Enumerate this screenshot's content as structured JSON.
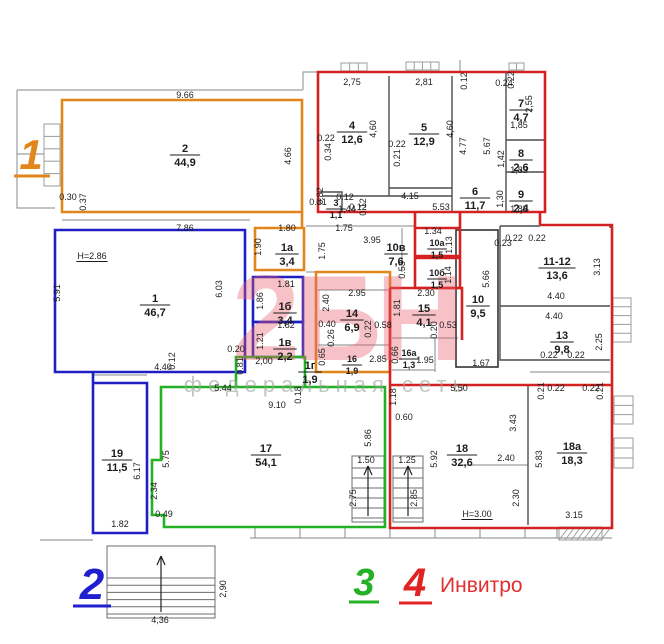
{
  "plan": {
    "wall_color": "#9a9d9f",
    "dark_wall_color": "#4a4d50",
    "dim_color": "#1c1c1c",
    "units": [
      {
        "id": "1",
        "label": "1",
        "color": "#e0861a"
      },
      {
        "id": "2",
        "label": "2",
        "color": "#1f1fc4"
      },
      {
        "id": "3",
        "label": "3",
        "color": "#25b125"
      },
      {
        "id": "4",
        "label": "4",
        "color": "#d42222",
        "name": "Инвитро"
      }
    ],
    "rooms": [
      {
        "n": "2",
        "a": "44,9",
        "x": 185,
        "y": 155
      },
      {
        "n": "1",
        "a": "46,7",
        "x": 155,
        "y": 305
      },
      {
        "n": "19",
        "a": "11,5",
        "x": 117,
        "y": 460
      },
      {
        "n": "17",
        "a": "54,1",
        "x": 266,
        "y": 455
      },
      {
        "n": "18",
        "a": "32,6",
        "x": 462,
        "y": 455
      },
      {
        "n": "18а",
        "a": "18,3",
        "x": 572,
        "y": 453
      },
      {
        "n": "4",
        "a": "12,6",
        "x": 352,
        "y": 132
      },
      {
        "n": "5",
        "a": "12,9",
        "x": 424,
        "y": 134
      },
      {
        "n": "3",
        "a": "1,1",
        "x": 336,
        "y": 209,
        "s": 1
      },
      {
        "n": "6",
        "a": "11,7",
        "x": 475,
        "y": 198
      },
      {
        "n": "7",
        "a": "4,7",
        "x": 521,
        "y": 110
      },
      {
        "n": "8",
        "a": "2,6",
        "x": 521,
        "y": 160
      },
      {
        "n": "9",
        "a": "2,4",
        "x": 521,
        "y": 201
      },
      {
        "n": "1а",
        "a": "3,4",
        "x": 287,
        "y": 254
      },
      {
        "n": "10в",
        "a": "7,6",
        "x": 396,
        "y": 254
      },
      {
        "n": "10а",
        "a": "1,5",
        "x": 437,
        "y": 249,
        "s": 1
      },
      {
        "n": "10б",
        "a": "1,5",
        "x": 437,
        "y": 279,
        "s": 1
      },
      {
        "n": "11-12",
        "a": "13,6",
        "x": 557,
        "y": 268
      },
      {
        "n": "1б",
        "a": "3,4",
        "x": 285,
        "y": 313
      },
      {
        "n": "14",
        "a": "6,9",
        "x": 352,
        "y": 320
      },
      {
        "n": "15",
        "a": "4,1",
        "x": 424,
        "y": 315
      },
      {
        "n": "10",
        "a": "9,5",
        "x": 478,
        "y": 306
      },
      {
        "n": "13",
        "a": "9,8",
        "x": 562,
        "y": 342
      },
      {
        "n": "1в",
        "a": "2,2",
        "x": 285,
        "y": 349
      },
      {
        "n": "16",
        "a": "1,9",
        "x": 352,
        "y": 365,
        "s": 1
      },
      {
        "n": "16а",
        "a": "1,3",
        "x": 409,
        "y": 359,
        "s": 1
      },
      {
        "n": "1г",
        "a": "1,9",
        "x": 310,
        "y": 372
      }
    ],
    "dims": [
      {
        "t": "9.66",
        "x": 185,
        "y": 98
      },
      {
        "t": "0.30",
        "x": 68,
        "y": 200
      },
      {
        "t": "0.37",
        "x": 86,
        "y": 202,
        "v": 1
      },
      {
        "t": "4.66",
        "x": 291,
        "y": 156,
        "v": 1
      },
      {
        "t": "7.86",
        "x": 185,
        "y": 231
      },
      {
        "t": "H=2.86",
        "x": 92,
        "y": 259,
        "u": 1
      },
      {
        "t": "5.91",
        "x": 60,
        "y": 293,
        "v": 1
      },
      {
        "t": "6.03",
        "x": 222,
        "y": 289,
        "v": 1
      },
      {
        "t": "4.40",
        "x": 163,
        "y": 370
      },
      {
        "t": "0.12",
        "x": 175,
        "y": 361,
        "v": 1
      },
      {
        "t": "0.20",
        "x": 236,
        "y": 352
      },
      {
        "t": "0.81",
        "x": 243,
        "y": 366,
        "v": 1
      },
      {
        "t": "1.80",
        "x": 287,
        "y": 231
      },
      {
        "t": "1.90",
        "x": 261,
        "y": 247,
        "v": 1
      },
      {
        "t": "1.75",
        "x": 344,
        "y": 231
      },
      {
        "t": "1.75",
        "x": 325,
        "y": 251,
        "v": 1
      },
      {
        "t": "3.95",
        "x": 372,
        "y": 243
      },
      {
        "t": "0.53",
        "x": 405,
        "y": 270,
        "v": 1
      },
      {
        "t": "1.34",
        "x": 433,
        "y": 234
      },
      {
        "t": "1.13",
        "x": 452,
        "y": 245,
        "v": 1
      },
      {
        "t": "1.14",
        "x": 451,
        "y": 275,
        "v": 1
      },
      {
        "t": "1.81",
        "x": 286,
        "y": 287
      },
      {
        "t": "1.86",
        "x": 263,
        "y": 301,
        "v": 1
      },
      {
        "t": "1.82",
        "x": 286,
        "y": 328
      },
      {
        "t": "1.21",
        "x": 263,
        "y": 341,
        "v": 1
      },
      {
        "t": "2,00",
        "x": 264,
        "y": 364
      },
      {
        "t": "2.95",
        "x": 357,
        "y": 296
      },
      {
        "t": "2.40",
        "x": 329,
        "y": 303,
        "v": 1
      },
      {
        "t": "0.40",
        "x": 327,
        "y": 327
      },
      {
        "t": "0.26",
        "x": 334,
        "y": 338,
        "v": 1
      },
      {
        "t": "0.22",
        "x": 371,
        "y": 329,
        "v": 1
      },
      {
        "t": "0.58",
        "x": 383,
        "y": 328
      },
      {
        "t": "2.30",
        "x": 426,
        "y": 296
      },
      {
        "t": "1.81",
        "x": 400,
        "y": 308,
        "v": 1
      },
      {
        "t": "0.20",
        "x": 437,
        "y": 330,
        "v": 1
      },
      {
        "t": "0.53",
        "x": 448,
        "y": 328
      },
      {
        "t": "0.65",
        "x": 325,
        "y": 357,
        "v": 1
      },
      {
        "t": "2.85",
        "x": 378,
        "y": 362
      },
      {
        "t": "0.66",
        "x": 398,
        "y": 355,
        "v": 1
      },
      {
        "t": "1.95",
        "x": 425,
        "y": 363
      },
      {
        "t": "5.66",
        "x": 489,
        "y": 279,
        "v": 1
      },
      {
        "t": "1.67",
        "x": 481,
        "y": 366
      },
      {
        "t": "0.23",
        "x": 503,
        "y": 246
      },
      {
        "t": "0.22",
        "x": 514,
        "y": 241
      },
      {
        "t": "0.22",
        "x": 537,
        "y": 241
      },
      {
        "t": "3.13",
        "x": 600,
        "y": 267,
        "v": 1
      },
      {
        "t": "4.40",
        "x": 556,
        "y": 299
      },
      {
        "t": "4.40",
        "x": 554,
        "y": 319
      },
      {
        "t": "2.25",
        "x": 602,
        "y": 342,
        "v": 1
      },
      {
        "t": "0.22",
        "x": 549,
        "y": 358
      },
      {
        "t": "0.22",
        "x": 576,
        "y": 358
      },
      {
        "t": "2,75",
        "x": 352,
        "y": 85
      },
      {
        "t": "2,81",
        "x": 424,
        "y": 85
      },
      {
        "t": "4,60",
        "x": 376,
        "y": 129,
        "v": 1
      },
      {
        "t": "4,60",
        "x": 453,
        "y": 129,
        "v": 1
      },
      {
        "t": "0.22",
        "x": 326,
        "y": 141
      },
      {
        "t": "0.34",
        "x": 331,
        "y": 152,
        "v": 1
      },
      {
        "t": "0.22",
        "x": 397,
        "y": 147
      },
      {
        "t": "0.21",
        "x": 400,
        "y": 158,
        "v": 1
      },
      {
        "t": "4.77",
        "x": 466,
        "y": 146,
        "v": 1
      },
      {
        "t": "5.67",
        "x": 490,
        "y": 146,
        "v": 1
      },
      {
        "t": "4.15",
        "x": 410,
        "y": 199
      },
      {
        "t": "5.53",
        "x": 441,
        "y": 210
      },
      {
        "t": "0.12",
        "x": 467,
        "y": 81,
        "v": 1
      },
      {
        "t": "0.24",
        "x": 504,
        "y": 86
      },
      {
        "t": "0.22",
        "x": 514,
        "y": 80,
        "v": 1
      },
      {
        "t": "1,85",
        "x": 519,
        "y": 128
      },
      {
        "t": "2,55",
        "x": 532,
        "y": 104,
        "v": 1
      },
      {
        "t": "1,42",
        "x": 504,
        "y": 159,
        "v": 1
      },
      {
        "t": "1,83",
        "x": 519,
        "y": 173
      },
      {
        "t": "1,30",
        "x": 503,
        "y": 199,
        "v": 1
      },
      {
        "t": "1,85",
        "x": 519,
        "y": 212
      },
      {
        "t": "0.31",
        "x": 318,
        "y": 205
      },
      {
        "t": "0.82",
        "x": 323,
        "y": 196,
        "v": 1
      },
      {
        "t": "0.12",
        "x": 345,
        "y": 200
      },
      {
        "t": "1,44",
        "x": 347,
        "y": 212
      },
      {
        "t": "0.12",
        "x": 358,
        "y": 210
      },
      {
        "t": "0.12",
        "x": 366,
        "y": 207,
        "v": 1
      },
      {
        "t": "5.44",
        "x": 223,
        "y": 391
      },
      {
        "t": "9.10",
        "x": 277,
        "y": 408
      },
      {
        "t": "0.18",
        "x": 301,
        "y": 395,
        "v": 1
      },
      {
        "t": "5.75",
        "x": 169,
        "y": 459,
        "v": 1
      },
      {
        "t": "2.34",
        "x": 157,
        "y": 491,
        "v": 1
      },
      {
        "t": "0.49",
        "x": 164,
        "y": 517
      },
      {
        "t": "5.86",
        "x": 371,
        "y": 438,
        "v": 1
      },
      {
        "t": "1.50",
        "x": 366,
        "y": 463
      },
      {
        "t": "2.75",
        "x": 356,
        "y": 498,
        "v": 1
      },
      {
        "t": "6.17",
        "x": 140,
        "y": 471,
        "v": 1
      },
      {
        "t": "1.82",
        "x": 120,
        "y": 527
      },
      {
        "t": "5.50",
        "x": 459,
        "y": 391
      },
      {
        "t": "1.18",
        "x": 396,
        "y": 397,
        "v": 1
      },
      {
        "t": "0.60",
        "x": 404,
        "y": 420
      },
      {
        "t": "3.43",
        "x": 516,
        "y": 423,
        "v": 1
      },
      {
        "t": "5.92",
        "x": 437,
        "y": 459,
        "v": 1
      },
      {
        "t": "2.40",
        "x": 506,
        "y": 461
      },
      {
        "t": "2.30",
        "x": 519,
        "y": 498,
        "v": 1
      },
      {
        "t": "1.25",
        "x": 407,
        "y": 463
      },
      {
        "t": "2.85",
        "x": 417,
        "y": 498,
        "v": 1
      },
      {
        "t": "H=3.00",
        "x": 477,
        "y": 517,
        "u": 1
      },
      {
        "t": "5.83",
        "x": 542,
        "y": 459,
        "v": 1
      },
      {
        "t": "3.15",
        "x": 574,
        "y": 518
      },
      {
        "t": "0.21",
        "x": 544,
        "y": 391,
        "v": 1
      },
      {
        "t": "0.22",
        "x": 556,
        "y": 391
      },
      {
        "t": "0.22",
        "x": 591,
        "y": 391
      },
      {
        "t": "0.21",
        "x": 603,
        "y": 391,
        "v": 1
      },
      {
        "t": "2,90",
        "x": 226,
        "y": 589,
        "v": 1
      },
      {
        "t": "4,36",
        "x": 160,
        "y": 623
      }
    ]
  },
  "watermark": {
    "title": "2БН",
    "title_color": "#e85f6e",
    "subtitle": "федеральная сеть",
    "subtitle_color": "#97a297"
  },
  "legend": {
    "items": [
      {
        "num": "1",
        "color": "#e0861a"
      },
      {
        "num": "2",
        "color": "#1f1fd0"
      },
      {
        "num": "3",
        "color": "#25b125"
      },
      {
        "num": "4",
        "color": "#e02424"
      }
    ],
    "company": "Инвитро",
    "company_color": "#e03030"
  }
}
